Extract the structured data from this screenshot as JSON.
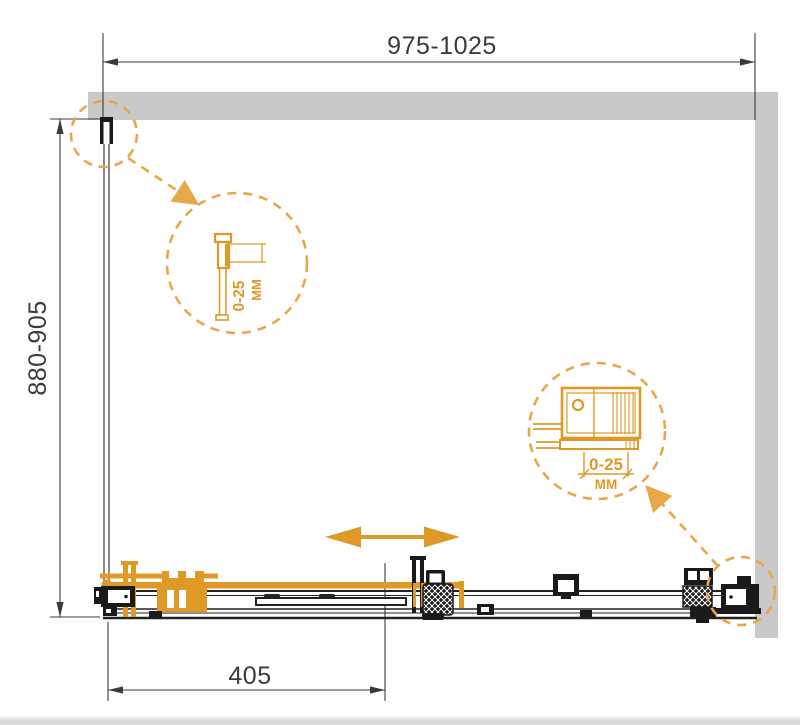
{
  "diagram": {
    "type": "shower-enclosure-installation-drawing",
    "dimensions": {
      "width_range": "975-1025",
      "depth_range": "880-905",
      "door_opening": "405"
    },
    "details": {
      "wall_profile": {
        "value": "0-25",
        "unit": "ММ"
      },
      "roller": {
        "value": "0-25",
        "unit": "ММ"
      }
    },
    "colors": {
      "accent": "#DE9927",
      "dashed_accent": "#E8A848",
      "wall": "#C9C9C9",
      "dimension_lines": "#3B3B3B",
      "hardware": "#1A1A1A"
    }
  }
}
